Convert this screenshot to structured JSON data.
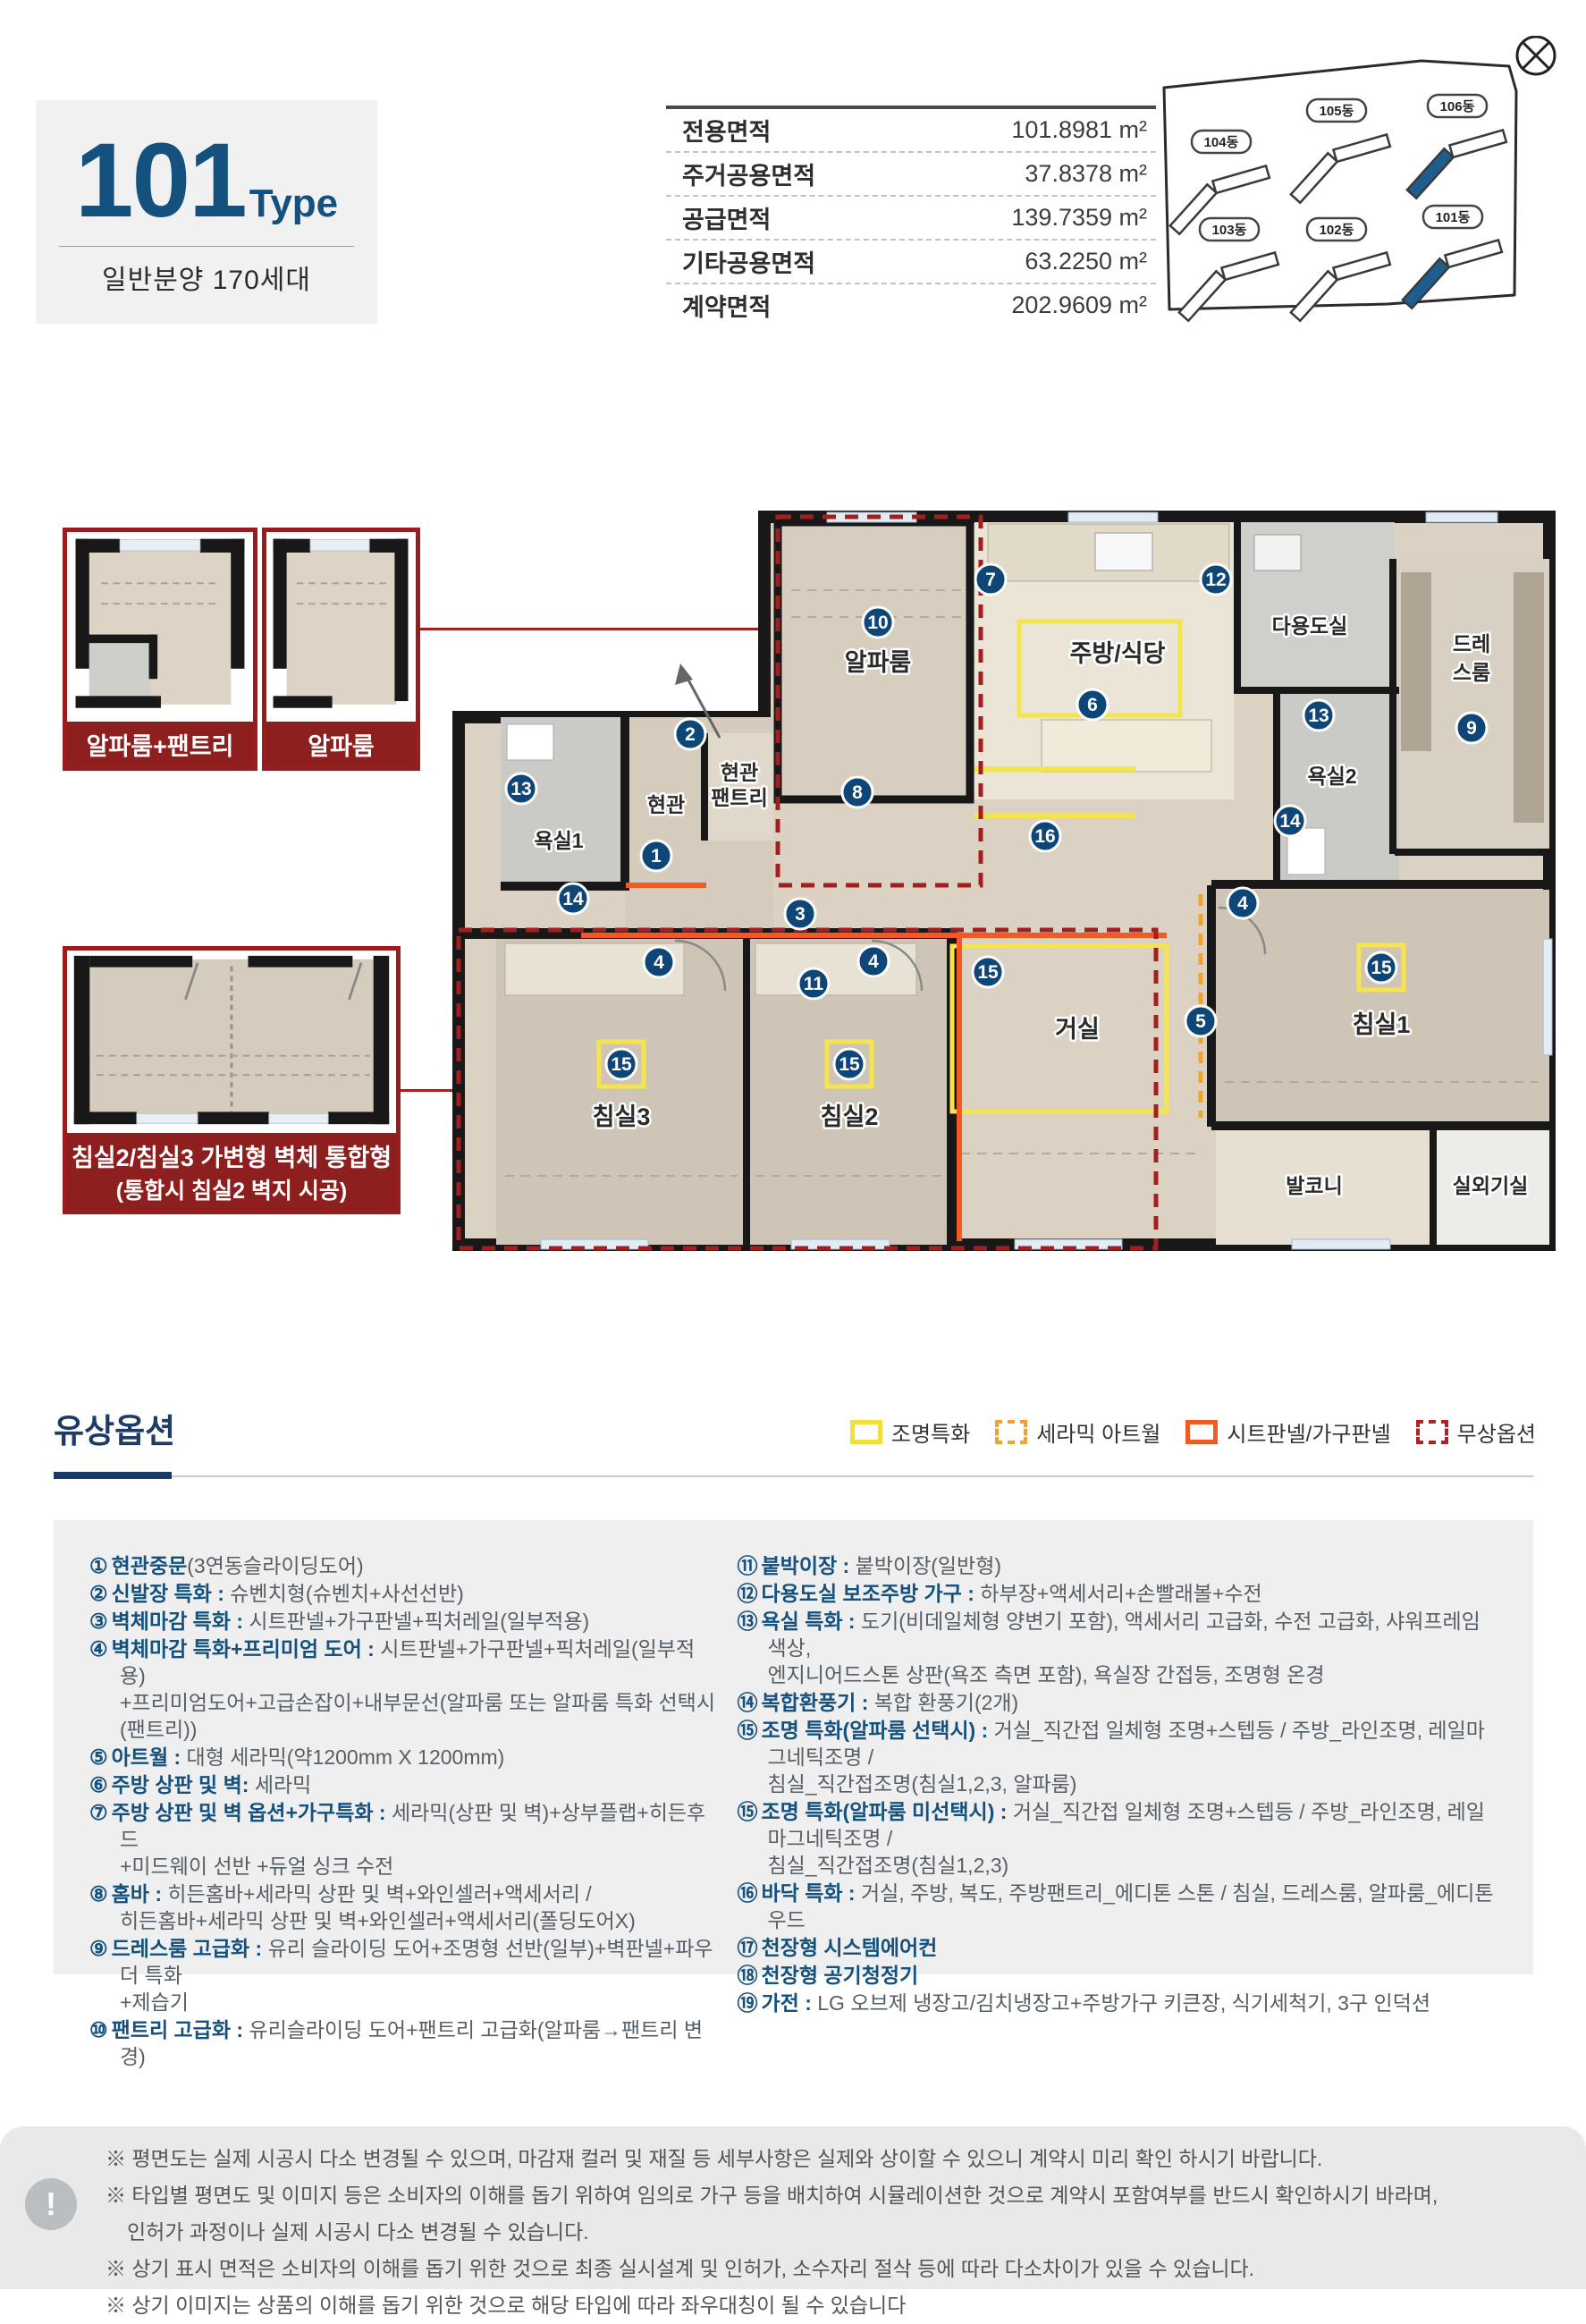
{
  "header": {
    "type_number": "101",
    "type_suffix": "Type",
    "subtitle": "일반분양 170세대",
    "area_table": [
      {
        "label": "전용면적",
        "value": "101.8981 m²"
      },
      {
        "label": "주거공용면적",
        "value": "37.8378 m²"
      },
      {
        "label": "공급면적",
        "value": "139.7359 m²"
      },
      {
        "label": "기타공용면적",
        "value": "63.2250 m²"
      },
      {
        "label": "계약면적",
        "value": "202.9609 m²"
      }
    ]
  },
  "site_plan": {
    "buildings": [
      "104동",
      "105동",
      "106동",
      "103동",
      "102동",
      "101동"
    ],
    "highlight_color": "#1d5e8f"
  },
  "floorplan": {
    "variants": [
      {
        "caption": "알파룸+팬트리"
      },
      {
        "caption": "알파룸"
      },
      {
        "caption_line1": "침실2/침실3 가변형 벽체 통합형",
        "caption_line2": "(통합시 침실2 벽지 시공)"
      }
    ],
    "room_labels": {
      "entry": "현관",
      "entry_pantry_l1": "현관",
      "entry_pantry_l2": "팬트리",
      "bath1": "욕실1",
      "alpha": "알파룸",
      "kitchen": "주방/식당",
      "utility": "다용도실",
      "dress_l1": "드레",
      "dress_l2": "스룸",
      "bath2": "욕실2",
      "living": "거실",
      "bed1": "침실1",
      "bed2": "침실2",
      "bed3": "침실3",
      "balcony": "발코니",
      "outdoor_unit": "실외기실"
    },
    "markers": [
      "1",
      "2",
      "3",
      "4",
      "4",
      "4",
      "5",
      "6",
      "7",
      "8",
      "9",
      "10",
      "11",
      "12",
      "13",
      "13",
      "14",
      "14",
      "15",
      "15",
      "15",
      "15",
      "16"
    ]
  },
  "options": {
    "title": "유상옵션",
    "legend": [
      {
        "label": "조명특화",
        "color": "#f2de3d",
        "style": "solid"
      },
      {
        "label": "세라믹 아트월",
        "color": "#f0a32e",
        "style": "dashed"
      },
      {
        "label": "시트판넬/가구판넬",
        "color": "#f15a22",
        "style": "solid"
      },
      {
        "label": "무상옵션",
        "color": "#b51f1f",
        "style": "dashed"
      }
    ],
    "left": [
      {
        "num": "①",
        "label": "현관중문",
        "text": "(3연동슬라이딩도어)"
      },
      {
        "num": "②",
        "label": "신발장 특화 : ",
        "text": "슈벤치형(슈벤치+사선선반)"
      },
      {
        "num": "③",
        "label": "벽체마감 특화 : ",
        "text": "시트판넬+가구판넬+픽처레일(일부적용)"
      },
      {
        "num": "④",
        "label": "벽체마감 특화+프리미엄 도어 : ",
        "text": "시트판넬+가구판넬+픽처레일(일부적용)\n+프리미엄도어+고급손잡이+내부문선(알파룸 또는 알파룸 특화 선택시(팬트리))"
      },
      {
        "num": "⑤",
        "label": "아트월 : ",
        "text": "대형 세라믹(약1200mm X 1200mm)"
      },
      {
        "num": "⑥",
        "label": "주방 상판 및 벽: ",
        "text": "세라믹"
      },
      {
        "num": "⑦",
        "label": "주방 상판 및 벽 옵션+가구특화 : ",
        "text": "세라믹(상판 및 벽)+상부플랩+히든후드\n+미드웨이 선반 +듀얼 싱크 수전"
      },
      {
        "num": "⑧",
        "label": "홈바 : ",
        "text": "히든홈바+세라믹 상판 및 벽+와인셀러+액세서리 /\n히든홈바+세라믹 상판 및 벽+와인셀러+액세서리(폴딩도어X)"
      },
      {
        "num": "⑨",
        "label": "드레스룸 고급화 : ",
        "text": "유리 슬라이딩 도어+조명형 선반(일부)+벽판넬+파우더 특화\n+제습기"
      },
      {
        "num": "⑩",
        "label": "팬트리 고급화 : ",
        "text": "유리슬라이딩 도어+팬트리 고급화(알파룸→팬트리 변경)"
      }
    ],
    "right": [
      {
        "num": "⑪",
        "label": "붙박이장 : ",
        "text": "붙박이장(일반형)"
      },
      {
        "num": "⑫",
        "label": "다용도실 보조주방 가구 : ",
        "text": "하부장+액세서리+손빨래볼+수전"
      },
      {
        "num": "⑬",
        "label": "욕실 특화 : ",
        "text": "도기(비데일체형 양변기 포함), 액세서리 고급화, 수전 고급화, 샤워프레임 색상,\n엔지니어드스톤 상판(욕조 측면 포함), 욕실장 간접등, 조명형 온경"
      },
      {
        "num": "⑭",
        "label": "복합환풍기 : ",
        "text": "복합 환풍기(2개)"
      },
      {
        "num": "⑮",
        "label": "조명 특화(알파룸 선택시) : ",
        "text": "거실_직간접 일체형 조명+스텝등 / 주방_라인조명, 레일마그네틱조명 /\n침실_직간접조명(침실1,2,3, 알파룸)"
      },
      {
        "num": "⑮",
        "label": "조명 특화(알파룸 미선택시) : ",
        "text": "거실_직간접 일체형 조명+스텝등 / 주방_라인조명, 레일마그네틱조명 /\n침실_직간접조명(침실1,2,3)"
      },
      {
        "num": "⑯",
        "label": "바닥 특화 : ",
        "text": "거실, 주방, 복도, 주방팬트리_에디톤 스톤 / 침실, 드레스룸, 알파룸_에디톤 우드"
      },
      {
        "num": "⑰",
        "label": "천장형 시스템에어컨",
        "text": ""
      },
      {
        "num": "⑱",
        "label": "천장형 공기청정기",
        "text": ""
      },
      {
        "num": "⑲",
        "label": "가전 : ",
        "text": "LG 오브제 냉장고/김치냉장고+주방가구 키큰장, 식기세척기, 3구 인덕션"
      }
    ]
  },
  "footer": {
    "alert_icon": "!",
    "notes": [
      "※ 평면도는 실제 시공시 다소 변경될 수 있으며, 마감재 컬러 및 재질 등 세부사항은 실제와 상이할 수 있으니 계약시 미리 확인 하시기 바랍니다.",
      "※ 타입별 평면도 및 이미지 등은 소비자의 이해를 돕기 위하여 임의로 가구 등을 배치하여 시뮬레이션한 것으로 계약시 포함여부를 반드시 확인하시기 바라며,",
      "인허가 과정이나 실제 시공시 다소 변경될 수 있습니다.",
      "※ 상기 표시 면적은 소비자의 이해를 돕기 위한 것으로 최종 실시설계 및 인허가, 소수자리 절삭 등에 따라 다소차이가 있을 수 있습니다.",
      "※ 상기 이미지는 상품의 이해를 돕기 위한 것으로 해당 타입에 따라 좌우대칭이 될 수 있습니다"
    ]
  }
}
